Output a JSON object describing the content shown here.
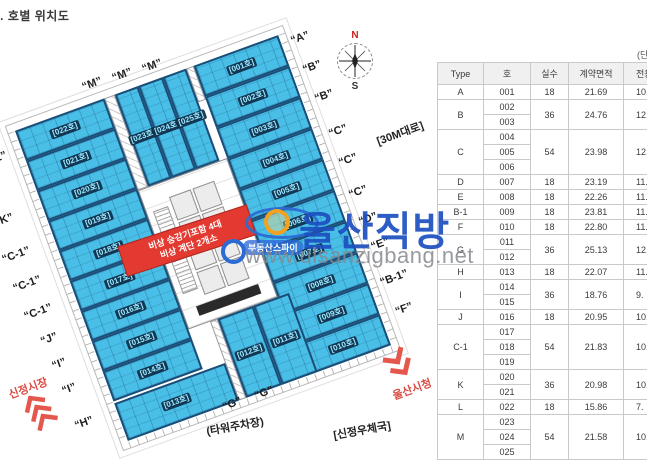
{
  "page": {
    "title": "4. 호별 위치도"
  },
  "plan": {
    "unit_fill": "#49bfe8",
    "left_units": [
      "[022호]",
      "[021호]",
      "[020호]",
      "[019호]",
      "[018호]",
      "[017호]",
      "[016호]",
      "[015호]",
      "[014호]"
    ],
    "left_corner_unit": "[013호]",
    "right_units": [
      "[001호]",
      "[002호]",
      "[003호]",
      "[004호]",
      "[005호]",
      "[006호]",
      "[007호]",
      "[008호]",
      "[009호]",
      "[010호]"
    ],
    "top_units": [
      "[023호]",
      "[024호]",
      "[025호]"
    ],
    "bottom_units": [
      "[012호]",
      "[011호]"
    ],
    "type_labels": {
      "right": [
        "“A”",
        "“B”",
        "“B”",
        "“C”",
        "“C”",
        "“C”",
        "“D”",
        "“E”",
        "“B-1”",
        "“F”"
      ],
      "left": [
        "“L”",
        "“K”",
        "“C-1”",
        "“C-1”",
        "“C-1”",
        "“J”",
        "“I”",
        "“I”",
        "“H”"
      ],
      "top": [
        "“M”",
        "“M”",
        "“M”"
      ],
      "bottom": [
        "“G”",
        "“G”"
      ]
    },
    "banner": {
      "line1": "비상 승강기포함 4대",
      "line2": "비상 계단 2개소"
    },
    "compass": {
      "n": "N",
      "s": "S"
    },
    "landmarks": {
      "road": "[30M대로]",
      "parking": "(타워주차장)",
      "post_office": "[신정우체국]",
      "city_hall": "울산시청",
      "market": "신정시장"
    }
  },
  "watermark": {
    "brand": "울산직방",
    "subtitle": "부동산스파이",
    "url": "www.ulsanzigbang.net"
  },
  "table": {
    "note": "(단위:㎡)",
    "headers": [
      "Type",
      "호",
      "실수",
      "계약면적",
      "전용면적"
    ],
    "groups": [
      {
        "type": "A",
        "units": [
          "001"
        ],
        "rooms": "18",
        "contract": "21.69",
        "exclusive": "10."
      },
      {
        "type": "B",
        "units": [
          "002",
          "003"
        ],
        "rooms": "36",
        "contract": "24.76",
        "exclusive": "12."
      },
      {
        "type": "C",
        "units": [
          "004",
          "005",
          "006"
        ],
        "rooms": "54",
        "contract": "23.98",
        "exclusive": "12."
      },
      {
        "type": "D",
        "units": [
          "007"
        ],
        "rooms": "18",
        "contract": "23.19",
        "exclusive": "11."
      },
      {
        "type": "E",
        "units": [
          "008"
        ],
        "rooms": "18",
        "contract": "22.26",
        "exclusive": "11."
      },
      {
        "type": "B-1",
        "units": [
          "009"
        ],
        "rooms": "18",
        "contract": "23.81",
        "exclusive": "11."
      },
      {
        "type": "F",
        "units": [
          "010"
        ],
        "rooms": "18",
        "contract": "22.80",
        "exclusive": "11."
      },
      {
        "type": "G",
        "units": [
          "011",
          "012"
        ],
        "rooms": "36",
        "contract": "25.13",
        "exclusive": "12."
      },
      {
        "type": "H",
        "units": [
          "013"
        ],
        "rooms": "18",
        "contract": "22.07",
        "exclusive": "11."
      },
      {
        "type": "I",
        "units": [
          "014",
          "015"
        ],
        "rooms": "36",
        "contract": "18.76",
        "exclusive": "9."
      },
      {
        "type": "J",
        "units": [
          "016"
        ],
        "rooms": "18",
        "contract": "20.95",
        "exclusive": "10."
      },
      {
        "type": "C-1",
        "units": [
          "017",
          "018",
          "019"
        ],
        "rooms": "54",
        "contract": "21.83",
        "exclusive": "10."
      },
      {
        "type": "K",
        "units": [
          "020",
          "021"
        ],
        "rooms": "36",
        "contract": "20.98",
        "exclusive": "10."
      },
      {
        "type": "L",
        "units": [
          "022"
        ],
        "rooms": "18",
        "contract": "15.86",
        "exclusive": "7."
      },
      {
        "type": "M",
        "units": [
          "023",
          "024",
          "025"
        ],
        "rooms": "54",
        "contract": "21.58",
        "exclusive": "10."
      }
    ]
  }
}
